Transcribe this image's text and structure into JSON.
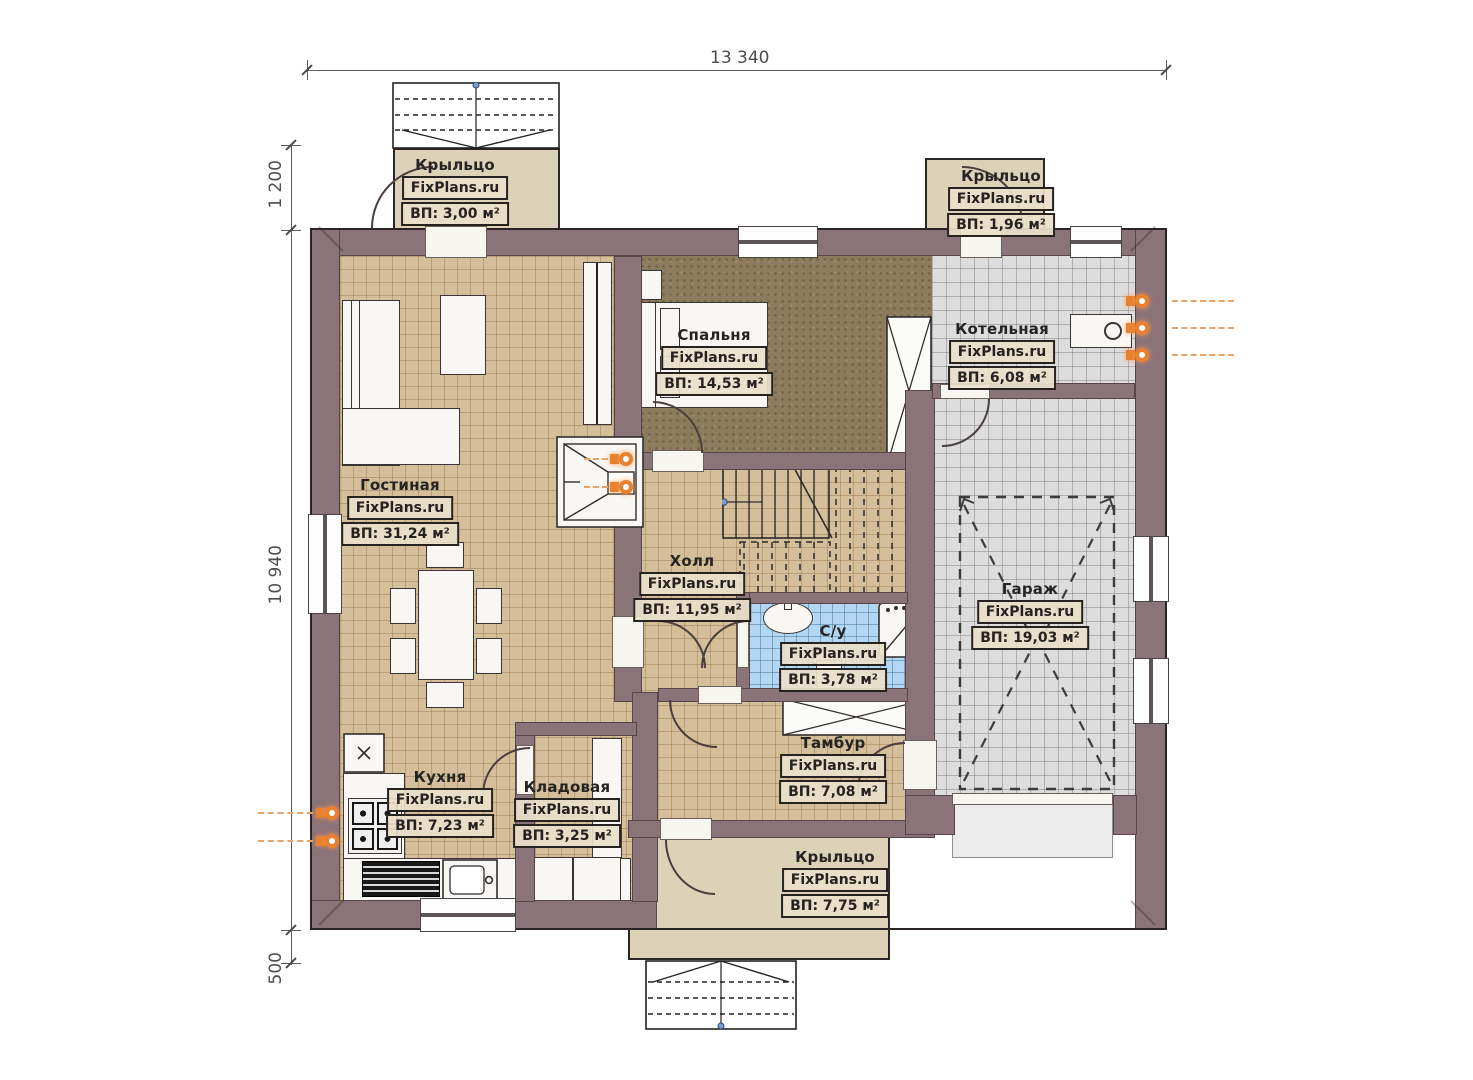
{
  "dimensions": {
    "top": "13 340",
    "left_upper": "1 200",
    "left_main": "10 940",
    "left_lower": "500"
  },
  "rooms": {
    "porch_top_left": {
      "name": "Крыльцо",
      "brand": "FixPlans.ru",
      "area": "ВП: 3,00 м²"
    },
    "porch_top_right": {
      "name": "Крыльцо",
      "brand": "FixPlans.ru",
      "area": "ВП: 1,96 м²"
    },
    "living": {
      "name": "Гостиная",
      "brand": "FixPlans.ru",
      "area": "ВП: 31,24 м²"
    },
    "bedroom": {
      "name": "Спальня",
      "brand": "FixPlans.ru",
      "area": "ВП: 14,53 м²"
    },
    "boiler": {
      "name": "Котельная",
      "brand": "FixPlans.ru",
      "area": "ВП: 6,08 м²"
    },
    "hall": {
      "name": "Холл",
      "brand": "FixPlans.ru",
      "area": "ВП: 11,95 м²"
    },
    "bathroom": {
      "name": "С/у",
      "brand": "FixPlans.ru",
      "area": "ВП: 3,78 м²"
    },
    "garage": {
      "name": "Гараж",
      "brand": "FixPlans.ru",
      "area": "ВП: 19,03 м²"
    },
    "vestibule": {
      "name": "Тамбур",
      "brand": "FixPlans.ru",
      "area": "ВП: 7,08 м²"
    },
    "kitchen": {
      "name": "Кухня",
      "brand": "FixPlans.ru",
      "area": "ВП: 7,23 м²"
    },
    "storage": {
      "name": "Кладовая",
      "brand": "FixPlans.ru",
      "area": "ВП: 3,25 м²"
    },
    "porch_bottom": {
      "name": "Крыльцо",
      "brand": "FixPlans.ru",
      "area": "ВП: 7,75 м²"
    }
  },
  "colors": {
    "wall": "#8b737a",
    "floor_tan": "#d5bf9a",
    "floor_carpet": "#8d7b5e",
    "floor_tile_gray": "#dddddd",
    "floor_tile_blue": "#b3d7f2",
    "porch": "#ddd1b7",
    "utility_accent": "#e8812f"
  }
}
